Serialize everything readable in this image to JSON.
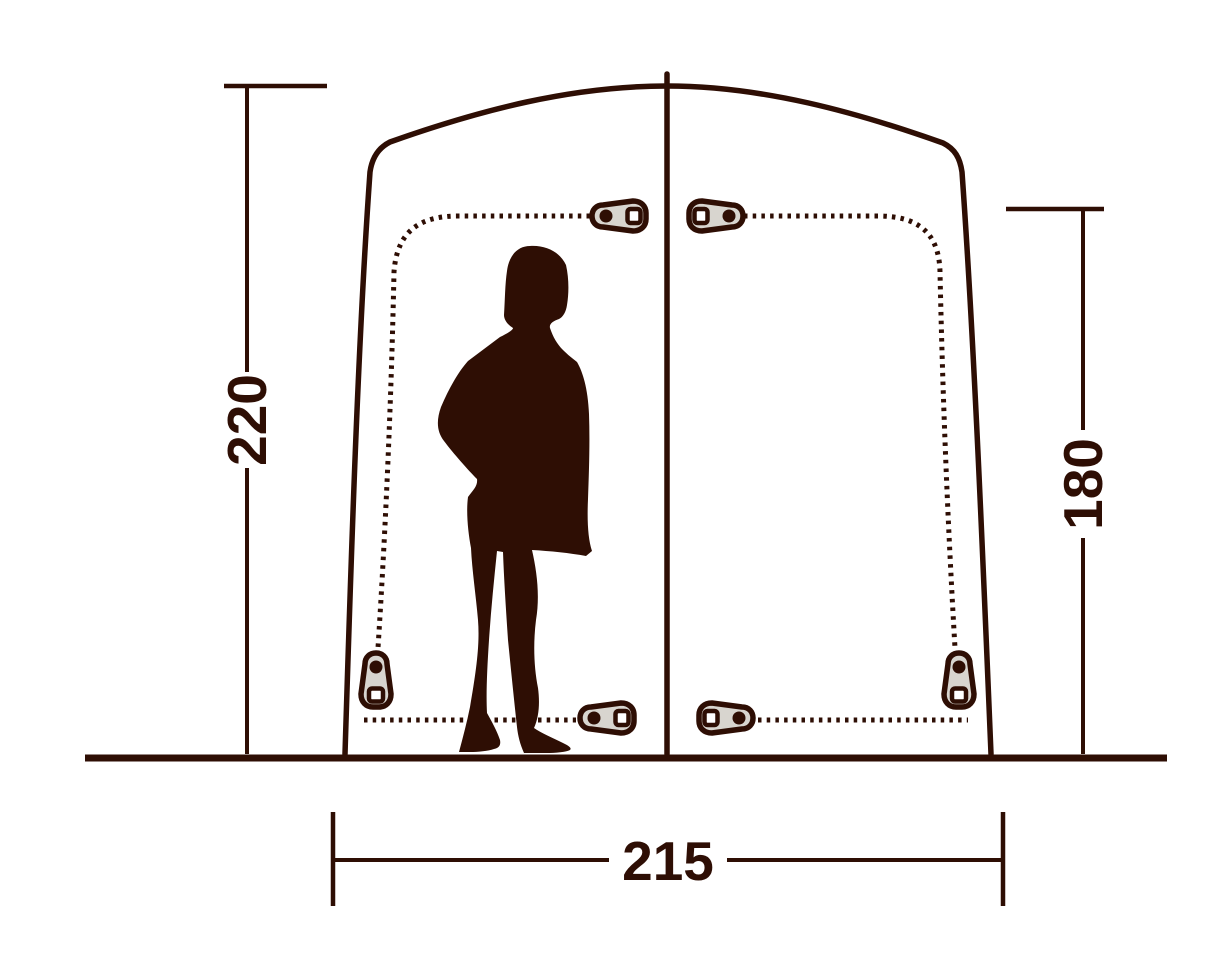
{
  "palette": {
    "ink": "#2e0e04",
    "pull_fill": "#d8d5cf",
    "hole": "#ffffff",
    "background": "#ffffff"
  },
  "dimensions": {
    "left_height_label": "220",
    "right_height_label": "180",
    "bottom_width_label": "215"
  },
  "icons": {
    "zipper_pull": "zipper-pull-icon",
    "person": "person-silhouette"
  }
}
